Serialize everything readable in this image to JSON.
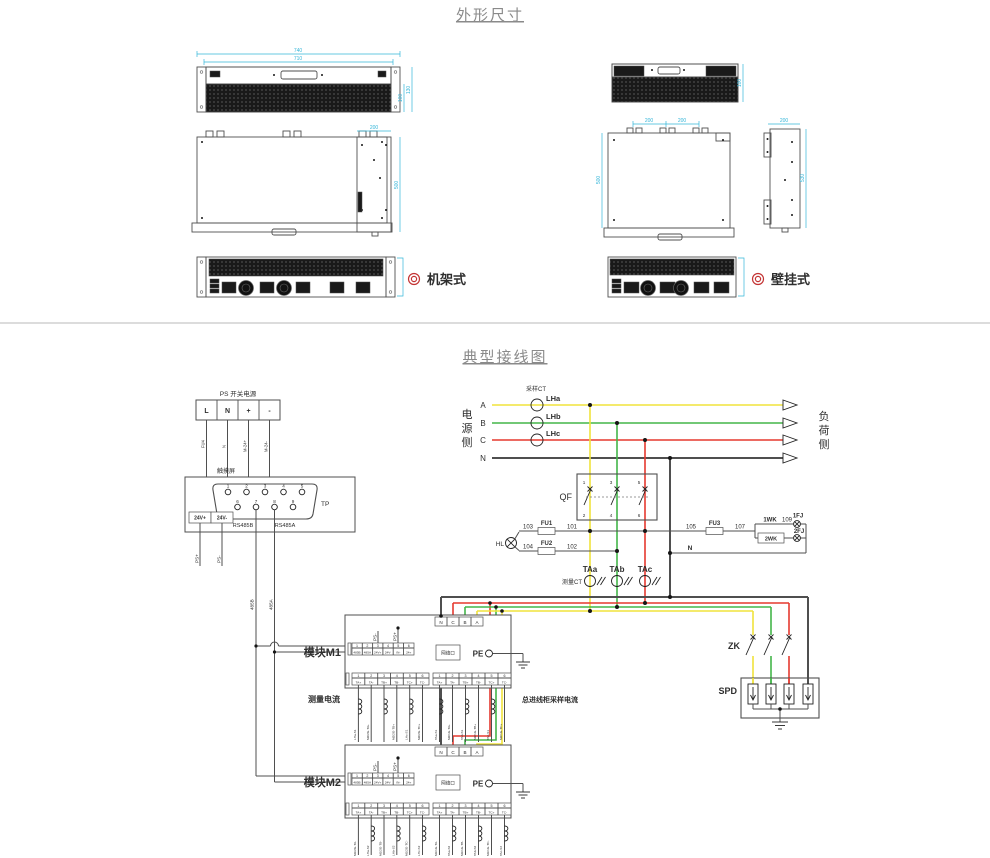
{
  "titles": {
    "section1": "外形尺寸",
    "section2": "典型接线图"
  },
  "accent_colors": {
    "phase_a": "#f0e33c",
    "phase_b": "#43b649",
    "phase_c": "#e5392f",
    "neutral": "#4f4f4f",
    "dimension": "#35b6d9",
    "marker": "#c33333"
  },
  "outline": {
    "rack": {
      "label": "机架式",
      "dim_w1": "740",
      "dim_w2": "710",
      "dim_h_outer": "130",
      "dim_h_inner": "100",
      "dim_depth": "500",
      "dim_side_w": "200"
    },
    "wall": {
      "label": "壁挂式",
      "dim_h": "100",
      "dim_tab1": "200",
      "dim_tab2": "200",
      "dim_depth": "500",
      "dim_side_w": "200",
      "dim_side_h": "530"
    }
  },
  "wiring": {
    "source_chars": [
      "电",
      "源",
      "侧"
    ],
    "load_chars": [
      "负",
      "荷",
      "侧"
    ],
    "sampling_ct": "采样CT",
    "measuring_ct": "测量CT",
    "phase_a": "A",
    "phase_b": "B",
    "phase_c": "C",
    "phase_n": "N",
    "lha": "LHa",
    "lhb": "LHb",
    "lhc": "LHc",
    "taa": "TAa",
    "tab": "TAb",
    "tac": "TAc",
    "qf": "QF",
    "qf_t1": "1",
    "qf_t2": "2",
    "qf_t3": "3",
    "qf_t4": "4",
    "qf_t5": "5",
    "qf_t6": "6",
    "hl": "HL",
    "w101": "101",
    "w102": "102",
    "w103": "103",
    "w104": "104",
    "w105": "105",
    "w107": "107",
    "w109": "109",
    "fu1": "FU1",
    "fu2": "FU2",
    "fu3": "FU3",
    "wk1": "1WK",
    "wk2": "2WK",
    "fj1": "1FJ",
    "fj2": "2FJ",
    "n_return": "N",
    "zk": "ZK",
    "spd": "SPD",
    "ps_title": "PS 开关电源",
    "ps_l": "L",
    "ps_n": "N",
    "ps_p": "+",
    "ps_m": "-",
    "ps_w1": "FU4",
    "ps_w2": "N",
    "ps_w3": "M-24+",
    "ps_w4": "M-24-",
    "touch_title": "触摸屏",
    "tp": "TP",
    "pins_top": [
      "1",
      "2",
      "3",
      "4",
      "5"
    ],
    "pins_bottom": [
      "6",
      "7",
      "8",
      "9"
    ],
    "t24p": "24V+",
    "t24m": "24V-",
    "rs485b": "RS485B",
    "rs485a": "RS485A",
    "psp": "PS+",
    "psm": "PS-",
    "b485": "485B",
    "a485": "485A",
    "m1": {
      "name": "模块M1",
      "note_left": "测量电流",
      "note_right": "总进线柜采样电流",
      "net": "网络口",
      "pe": "PE",
      "psm": "PS-",
      "psp": "PS+",
      "ncba": [
        "N",
        "C",
        "B",
        "A"
      ],
      "pnums": [
        "1",
        "2",
        "3",
        "4",
        "5",
        "6"
      ],
      "pterms": [
        "485B",
        "485A",
        "24V+",
        "24V-",
        "IN-",
        "24+"
      ],
      "cnums": [
        "1",
        "2",
        "3",
        "4",
        "5",
        "6"
      ],
      "cterms": [
        "TA+",
        "TA-",
        "TB+",
        "TB-",
        "TC+",
        "TC-"
      ],
      "lwires": [
        "LHa-S1",
        "M2/2G-TA+",
        "LHb-S1",
        "M2/2G-TB+",
        "LHc-S1",
        "M2/2G-TC+"
      ],
      "rwires": [
        "TAa-S1",
        "M2/1G-TA+",
        "TAb-S1",
        "M2/1G-TB+",
        "TAc-S1",
        "M2/1G-TC+"
      ]
    },
    "m2": {
      "name": "模块M2",
      "net": "网络口",
      "pe": "PE",
      "psm": "PS-",
      "psp": "PS+",
      "ncba": [
        "N",
        "C",
        "B",
        "A"
      ],
      "pnums": [
        "1",
        "2",
        "3",
        "4",
        "5",
        "6"
      ],
      "pterms": [
        "485B",
        "485A",
        "24V+",
        "24V-",
        "IN-",
        "24+"
      ],
      "cnums": [
        "1",
        "2",
        "3",
        "4",
        "5",
        "6"
      ],
      "cterms": [
        "TA+",
        "TA-",
        "TB+",
        "TB-",
        "TC+",
        "TC-"
      ],
      "lwires": [
        "M1/2G-TA-",
        "LHa-S2",
        "M1/2G-TB-",
        "LHb-S2",
        "M1/2G-TC-",
        "LHc-S2"
      ],
      "rwires": [
        "M1/1G-TA-",
        "TAa-S2",
        "M1/1G-TB-",
        "TAb-S2",
        "M1/1G-TC-",
        "TAc-S2"
      ]
    }
  }
}
